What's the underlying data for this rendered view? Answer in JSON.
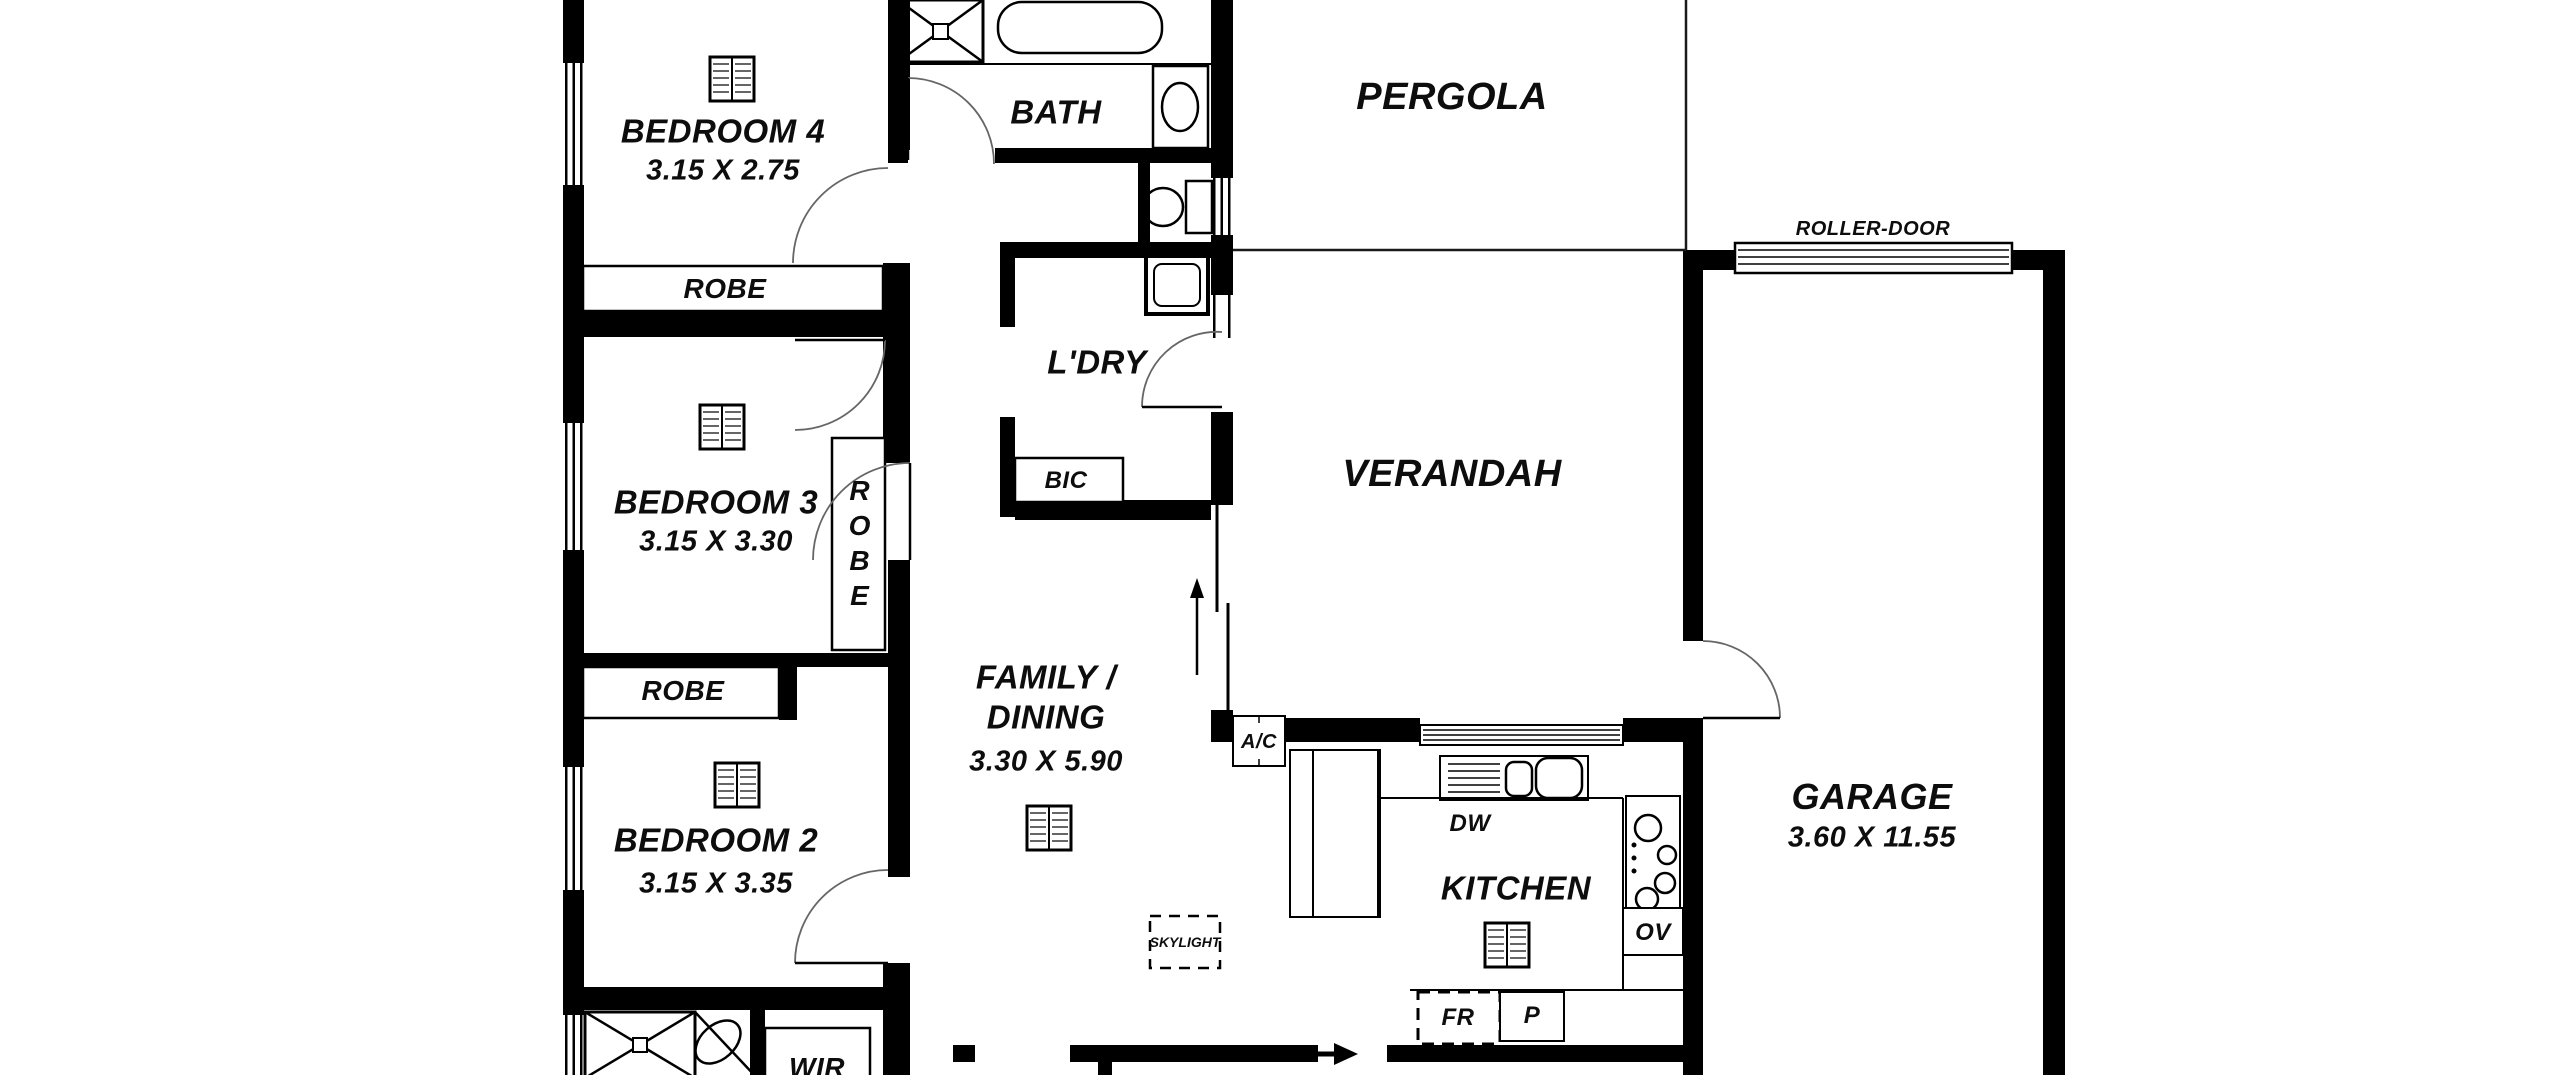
{
  "plan_title": "floor-plan",
  "rooms": {
    "bedroom4": {
      "name": "BEDROOM 4",
      "dims": "3.15 X 2.75"
    },
    "bedroom3": {
      "name": "BEDROOM 3",
      "dims": "3.15 X 3.30"
    },
    "bedroom2": {
      "name": "BEDROOM 2",
      "dims": "3.15 X 3.35"
    },
    "family": {
      "line1": "FAMILY /",
      "line2": "DINING",
      "dims": "3.30 X 5.90"
    },
    "kitchen": {
      "name": "KITCHEN"
    },
    "bath": {
      "name": "BATH"
    },
    "laundry": {
      "name": "L'DRY"
    },
    "pergola": {
      "name": "PERGOLA"
    },
    "verandah": {
      "name": "VERANDAH"
    },
    "garage": {
      "name": "GARAGE",
      "dims": "3.60 X 11.55"
    },
    "wir": {
      "name": "WIR"
    }
  },
  "labels": {
    "robe4": "ROBE",
    "robe3": "ROBE",
    "robe2": "ROBE",
    "bic": "BIC",
    "roller_door": "ROLLER-DOOR",
    "skylight": "SKYLIGHT",
    "ac": "A/C",
    "dw": "DW",
    "ov": "OV",
    "fr": "FR",
    "p": "P"
  },
  "colors": {
    "wall": "#000000",
    "background": "#ffffff",
    "door_arc": "#666666"
  }
}
